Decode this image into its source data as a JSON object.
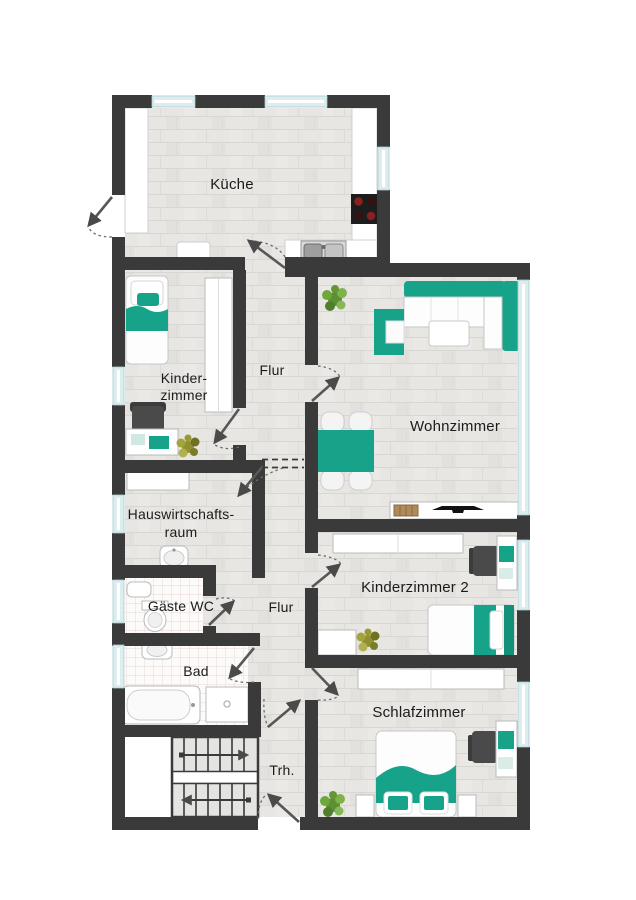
{
  "plan": {
    "type": "floor-plan",
    "labels": {
      "kueche": "Küche",
      "kinderzimmer_line1": "Kinder-",
      "kinderzimmer_line2": "zimmer",
      "flur_upper": "Flur",
      "wohnzimmer": "Wohnzimmer",
      "hwr_line1": "Hauswirtschafts-",
      "hwr_line2": "raum",
      "gaeste_wc": "Gäste WC",
      "flur_lower": "Flur",
      "bad": "Bad",
      "kinderzimmer2": "Kinderzimmer 2",
      "schlafzimmer": "Schlafzimmer",
      "treppenhaus": "Trh."
    },
    "colors": {
      "wall": "#3a3a3a",
      "accent_teal": "#17a38a",
      "window_glass": "#dcedef",
      "floor": "#e7e6e3",
      "plant_green": "#6fa13c",
      "plant_olive": "#989930"
    },
    "furniture": {
      "kueche": [
        "kitchen-counter",
        "stove",
        "kitchen-sink",
        "cabinet"
      ],
      "kinderzimmer": [
        "single-bed",
        "wardrobe",
        "desk",
        "desk-chair",
        "laptop",
        "plant"
      ],
      "wohnzimmer": [
        "corner-sofa",
        "armchair",
        "coffee-table",
        "dining-table",
        "dining-chairs",
        "sideboard",
        "tv",
        "plant"
      ],
      "hauswirtschaftsraum": [
        "closet",
        "utility-sink"
      ],
      "gaeste_wc": [
        "hand-basin",
        "toilet"
      ],
      "bad": [
        "wash-basin",
        "bathtub",
        "shower"
      ],
      "kinderzimmer2": [
        "wardrobe",
        "desk",
        "desk-chair",
        "single-bed",
        "plant"
      ],
      "schlafzimmer": [
        "wardrobe",
        "double-bed",
        "nightstand",
        "desk",
        "desk-chair",
        "plant"
      ],
      "treppenhaus": [
        "staircase",
        "entrance-door"
      ]
    }
  }
}
